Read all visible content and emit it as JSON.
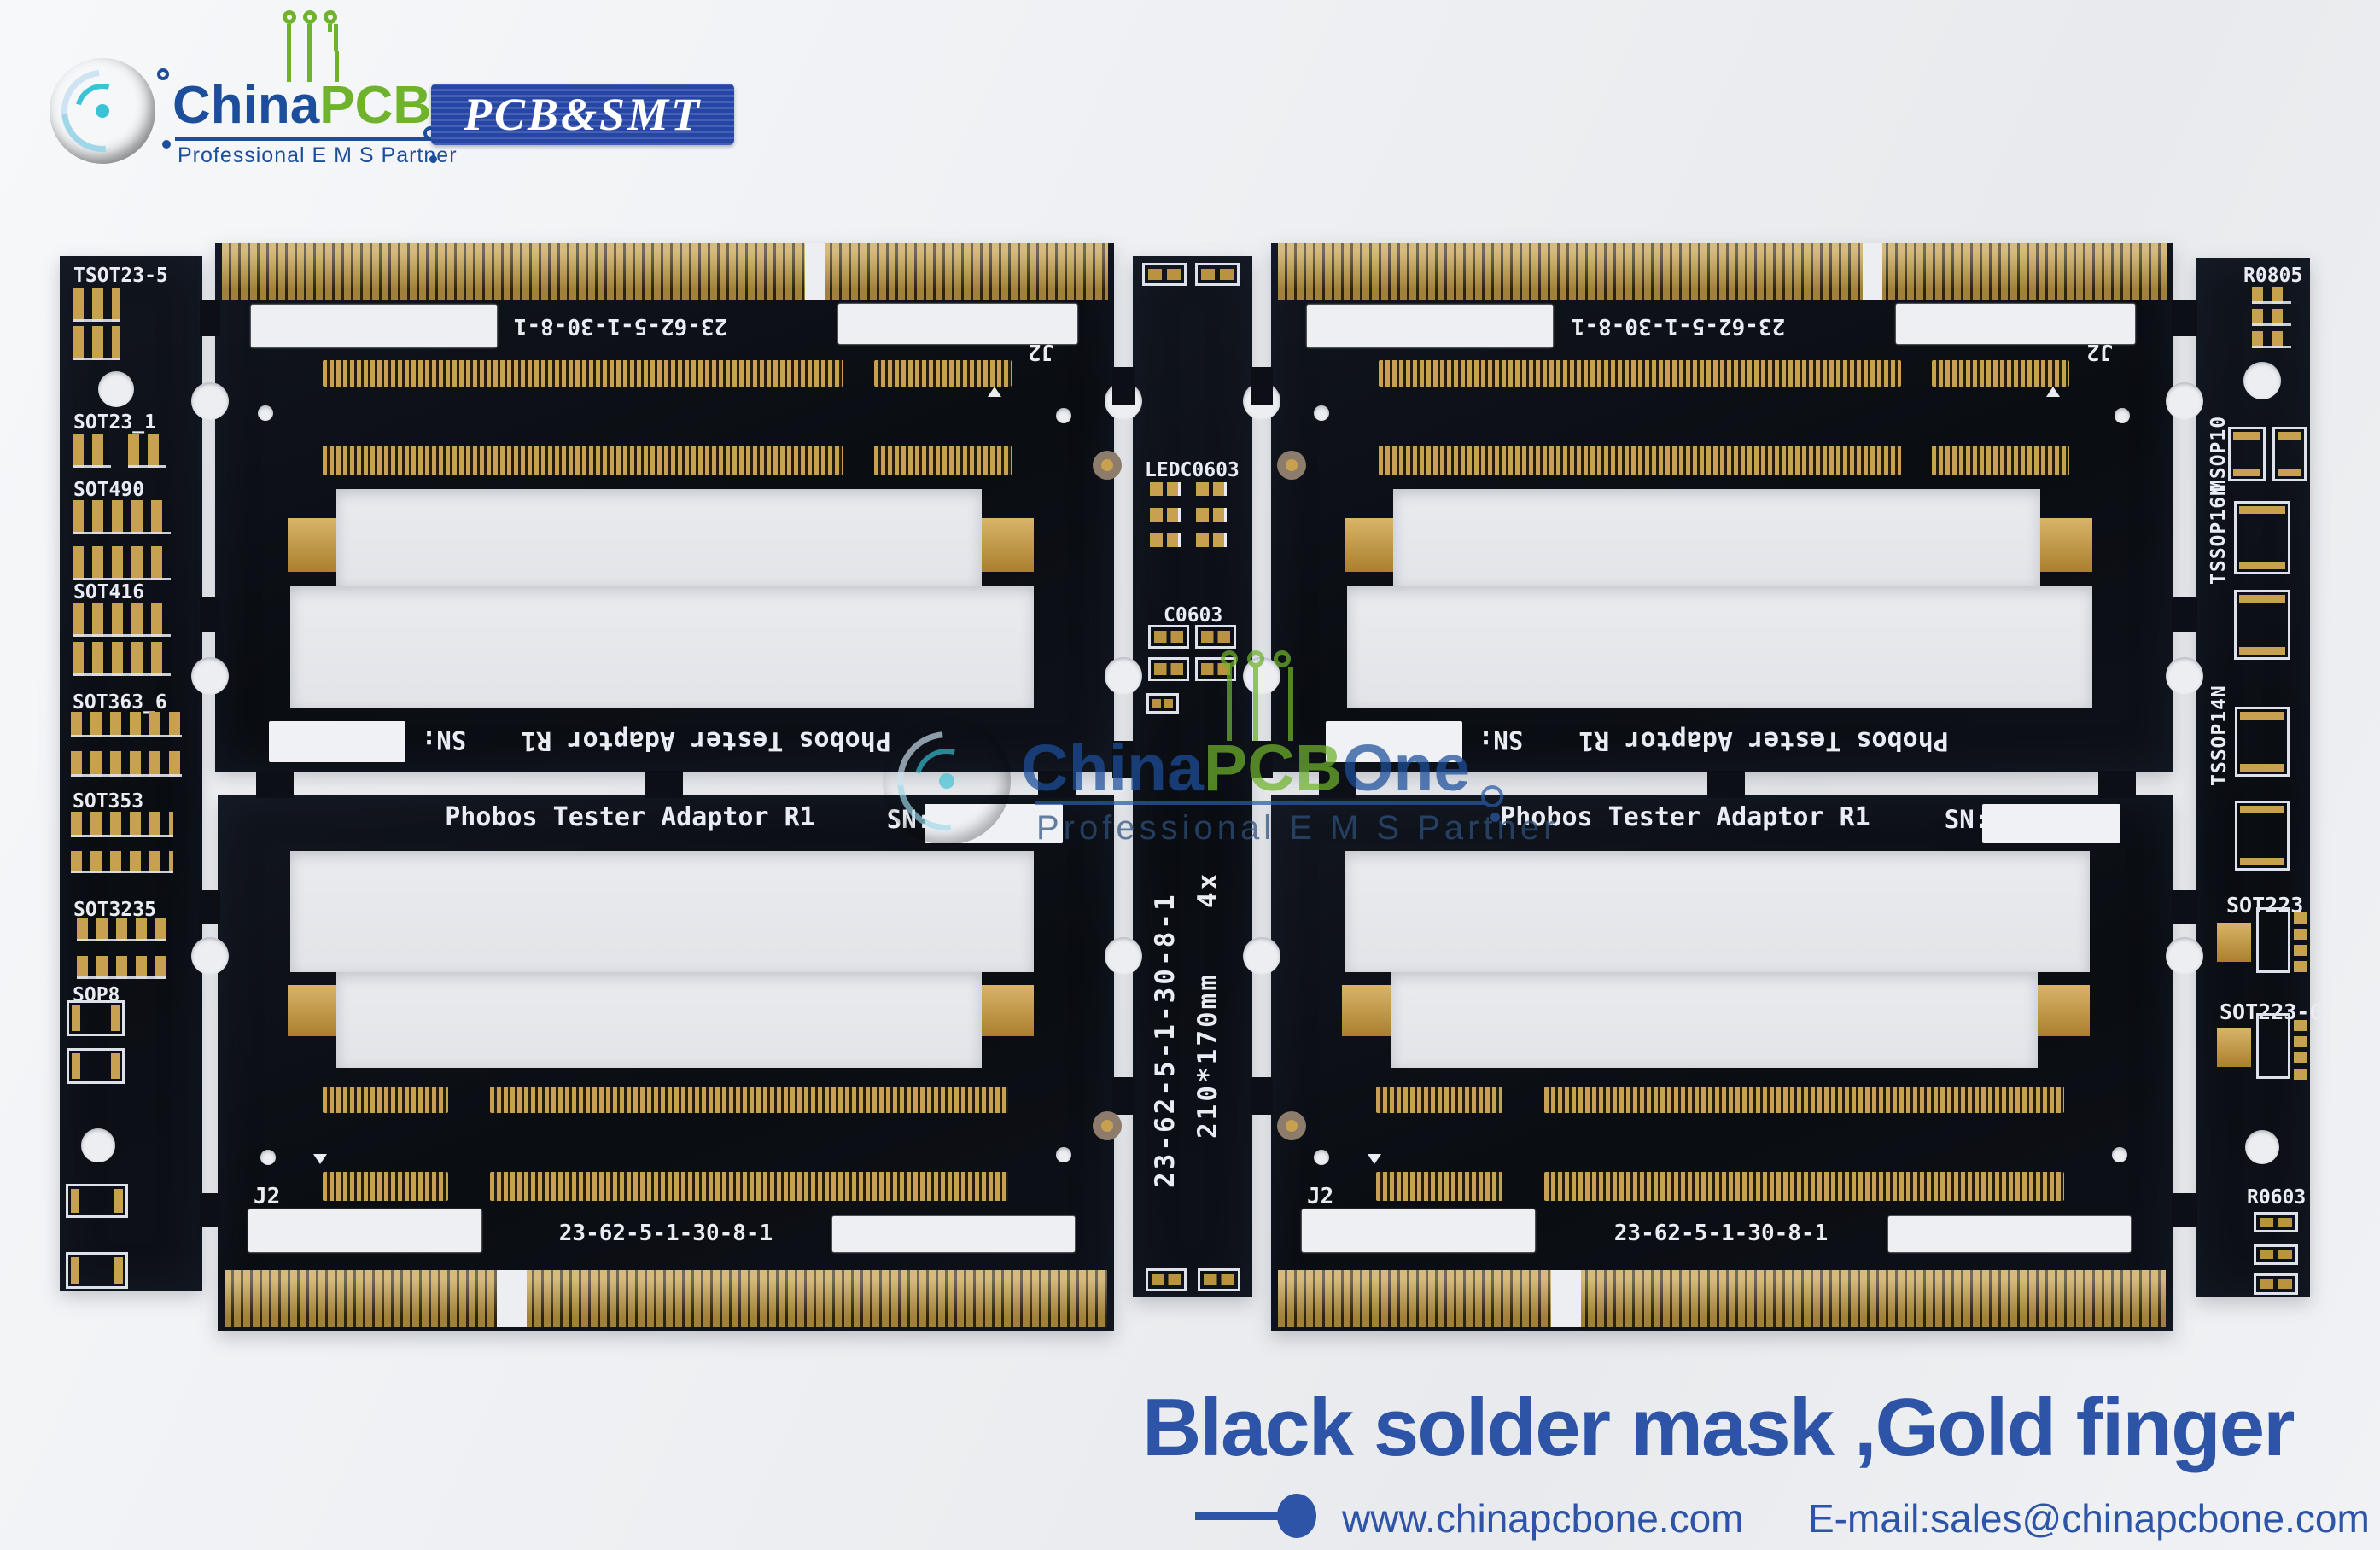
{
  "branding": {
    "name_part1": "China",
    "name_part2": "PCB",
    "name_part3": "One",
    "tagline": "Professional  E M S Partner",
    "badge": "PCB&SMT"
  },
  "headline": "Black solder mask ,Gold finger",
  "footer": {
    "website": "www.chinapcbone.com",
    "email": "E-mail:sales@chinapcbone.com"
  },
  "pcb": {
    "board_title": "Phobos Tester Adaptor R1",
    "sn_label": "SN:",
    "panel_id": "23-62-5-1-30-8-1",
    "panel_size": "210*170mm",
    "panel_qty": "4x",
    "connector_ref": "J2",
    "left_labels": [
      "TSOT23-5",
      "SOT23_1",
      "SOT490",
      "SOT416",
      "SOT363_6",
      "SOT353",
      "SOT3235",
      "SOP8"
    ],
    "right_labels": [
      "R0805",
      "MSOP10",
      "TSSOP16N",
      "TSSOP14N",
      "SOT223",
      "SOT223-6",
      "R0603"
    ],
    "center_labels": [
      "LEDC0603",
      "C0603"
    ]
  },
  "colors": {
    "gold": "#c7a14f",
    "solder_mask": "#0c0f15",
    "brand_blue": "#1d4e9b",
    "brand_green": "#6fb22c",
    "headline_blue": "#2d54a6"
  }
}
